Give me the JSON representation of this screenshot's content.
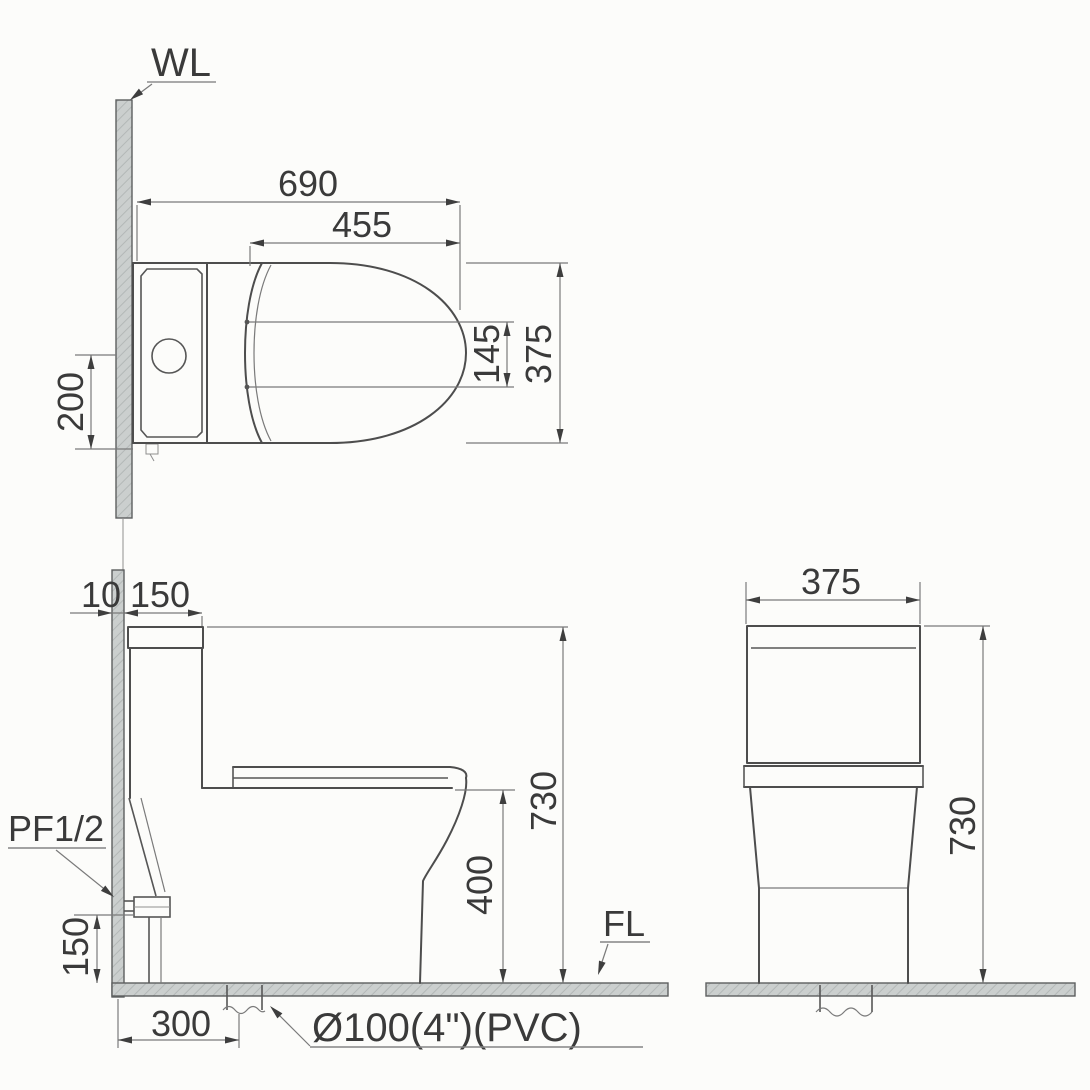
{
  "drawing": {
    "title": "Toilet installation dimension drawing (top, side and front views)",
    "units": "mm",
    "labels": {
      "wall_line": "WL",
      "floor_line": "FL",
      "supply_fitting": "PF1/2",
      "drain_pipe": "Ø100(4\")(PVC)"
    },
    "top_view": {
      "overall_length": "690",
      "seat_length": "455",
      "overall_width": "375",
      "hinge_spacing": "145",
      "side_offset": "200"
    },
    "side_view": {
      "wall_thickness": "10",
      "tank_depth": "150",
      "overall_height": "730",
      "bowl_height": "400",
      "supply_height": "150",
      "drain_set_out": "300"
    },
    "front_view": {
      "overall_width": "375",
      "overall_height": "730"
    }
  }
}
